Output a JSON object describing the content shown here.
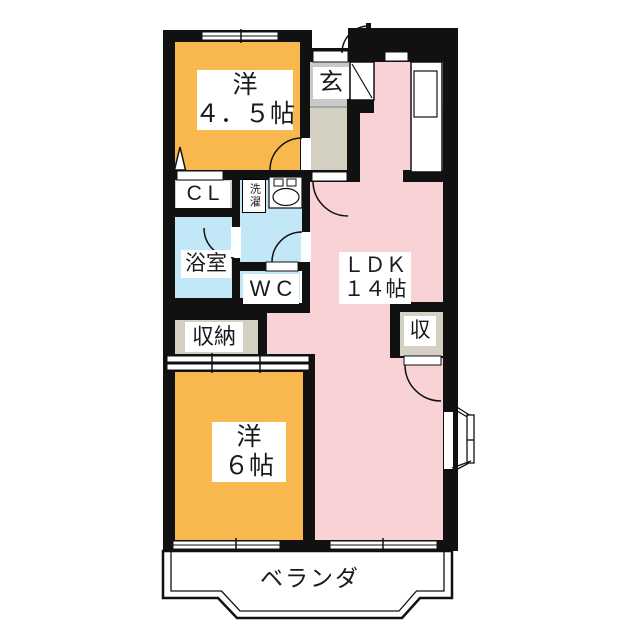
{
  "plan_title": "2LDK apartment floor plan",
  "colors": {
    "wall": "#111111",
    "room_orange": "#F8B84E",
    "ldk_pink": "#F8D2D5",
    "wet_blue": "#C2E7F7",
    "tile_gray": "#C9C9C9",
    "hall_beige": "#D3D0C2",
    "paper_white": "#FFFFFF"
  },
  "rooms": {
    "western_4_5": {
      "name": "洋",
      "size": "４．５帖"
    },
    "entrance": {
      "name": "玄"
    },
    "closet": {
      "name": "CL"
    },
    "laundry": {
      "name": "洗濯"
    },
    "bathroom": {
      "name": "浴室"
    },
    "toilet": {
      "name": "WC"
    },
    "storage": {
      "name": "収納"
    },
    "ldk": {
      "name": "ＬＤＫ",
      "size": "１４帖"
    },
    "storage_small": {
      "name": "収"
    },
    "western_6": {
      "name": "洋",
      "size": "６帖"
    },
    "veranda": {
      "name": "ベランダ"
    }
  }
}
